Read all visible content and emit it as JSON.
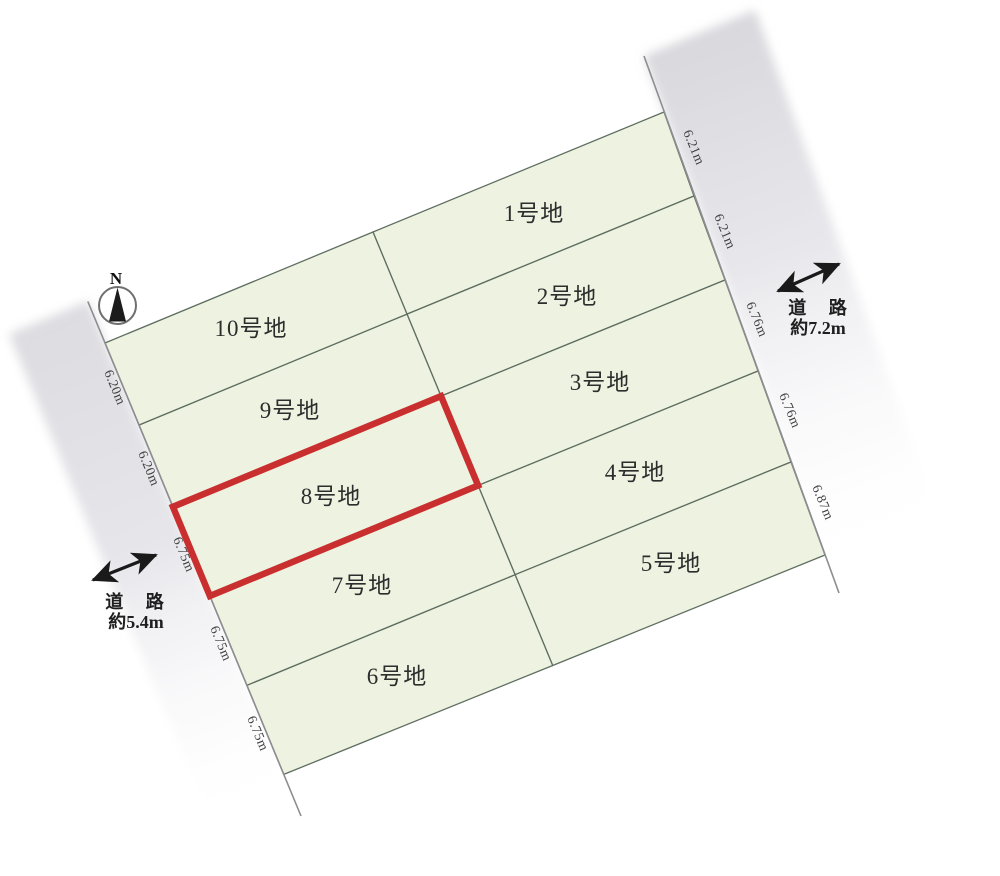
{
  "map_title": "宅地分譲区画図",
  "compass": {
    "label": "N"
  },
  "roads": {
    "right": {
      "label": "道 路",
      "width_label": "約7.2m"
    },
    "left": {
      "label": "道 路",
      "width_label": "約5.4m"
    }
  },
  "lots": [
    {
      "id": "lot-1",
      "label": "1号地",
      "frontage": "6.21m",
      "highlighted": false
    },
    {
      "id": "lot-2",
      "label": "2号地",
      "frontage": "6.21m",
      "highlighted": false
    },
    {
      "id": "lot-3",
      "label": "3号地",
      "frontage": "6.76m",
      "highlighted": false
    },
    {
      "id": "lot-4",
      "label": "4号地",
      "frontage": "6.76m",
      "highlighted": false
    },
    {
      "id": "lot-5",
      "label": "5号地",
      "frontage": "6.87m",
      "highlighted": false
    },
    {
      "id": "lot-6",
      "label": "6号地",
      "frontage": "6.75m",
      "highlighted": false
    },
    {
      "id": "lot-7",
      "label": "7号地",
      "frontage": "6.75m",
      "highlighted": false
    },
    {
      "id": "lot-8",
      "label": "8号地",
      "frontage": "6.75m",
      "highlighted": true
    },
    {
      "id": "lot-9",
      "label": "9号地",
      "frontage": "6.20m",
      "highlighted": false
    },
    {
      "id": "lot-10",
      "label": "10号地",
      "frontage": "6.20m",
      "highlighted": false
    }
  ],
  "colors": {
    "lot_fill": "#edf2e1",
    "lot_stroke": "#5f6e60",
    "highlight_red": "#c92f2f",
    "road_gray": "#dfdfe4",
    "text": "#2d2d2d"
  }
}
